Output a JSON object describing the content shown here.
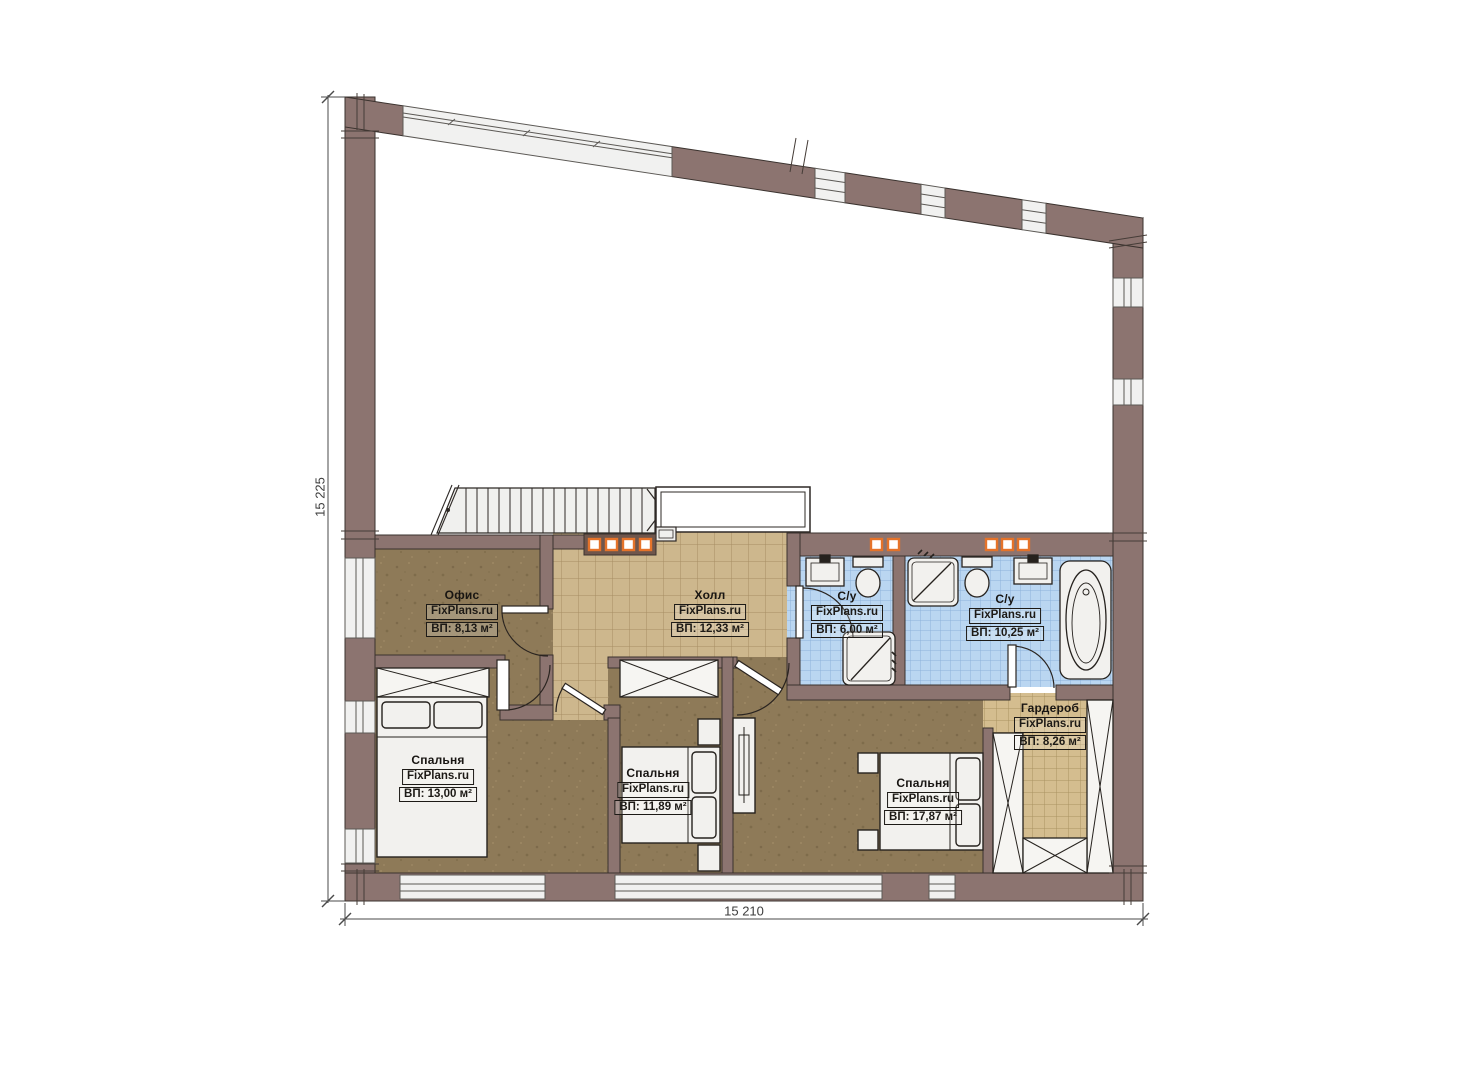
{
  "meta": {
    "document_type": "floor-plan",
    "watermark": "FixPlans.ru"
  },
  "colors": {
    "wall": "#8c7470",
    "wall_outline": "#3a322e",
    "floor_brown": "#8e7a58",
    "hall_tile": "#cdb78d",
    "hall_tile_line": "#a68e62",
    "wardrobe_tile": "#d4bd8f",
    "bath_tile": "#bad6f1",
    "bath_tile_line": "#8db2da",
    "fixture_fill": "#f2f1ee",
    "fixture_stroke": "#26221e",
    "window_fill": "#f1f1f0",
    "railing_dark": "#6f564c",
    "accent_orange": "#e5732a",
    "dimension_color": "#3d3d3d"
  },
  "dimensions": {
    "height_total": "15 225",
    "width_total": "15 210"
  },
  "rooms": [
    {
      "id": "office",
      "name": "Офис",
      "brand": "FixPlans.ru",
      "area_label": "ВП: 8,13 м²"
    },
    {
      "id": "hall",
      "name": "Холл",
      "brand": "FixPlans.ru",
      "area_label": "ВП: 12,33 м²"
    },
    {
      "id": "bath-small",
      "name": "С/у",
      "brand": "FixPlans.ru",
      "area_label": "ВП: 6,00 м²"
    },
    {
      "id": "bath-big",
      "name": "С/у",
      "brand": "FixPlans.ru",
      "area_label": "ВП: 10,25 м²"
    },
    {
      "id": "wardrobe",
      "name": "Гардероб",
      "brand": "FixPlans.ru",
      "area_label": "ВП: 8,26 м²"
    },
    {
      "id": "bedroom-1",
      "name": "Спальня",
      "brand": "FixPlans.ru",
      "area_label": "ВП: 13,00 м²"
    },
    {
      "id": "bedroom-2",
      "name": "Спальня",
      "brand": "FixPlans.ru",
      "area_label": "ВП: 11,89 м²"
    },
    {
      "id": "bedroom-3",
      "name": "Спальня",
      "brand": "FixPlans.ru",
      "area_label": "ВП: 17,87 м²"
    }
  ]
}
